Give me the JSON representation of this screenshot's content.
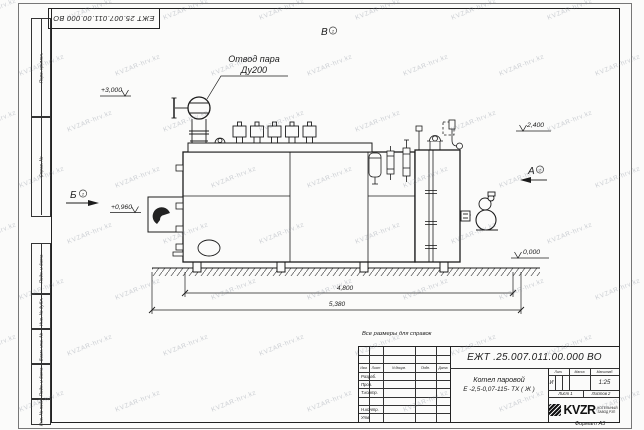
{
  "sheet": {
    "top_designation": "ЕЖТ 25.007.011.00.000  ВО",
    "format_note": "Формат А3",
    "left_cells": [
      "Перв. примен.",
      "Справ. №",
      "Подп. и дата",
      "Инв. № дубл.",
      "Взам. инв. №",
      "Подп. и дата",
      "Инв. № подл."
    ]
  },
  "watermark": {
    "text": "KVZAR-hrv.kz"
  },
  "drawing": {
    "note": "Все размеры для справок",
    "callout_line1": "Отвод пара",
    "callout_line2": "Ду200",
    "elev_3000": "+3,000",
    "elev_2400": "2,400",
    "elev_0960": "+0,960",
    "elev_0000": "0,000",
    "dim_4800": "4,800",
    "dim_5380": "5,380",
    "view_a": "А",
    "view_b": "Б",
    "view_v": "В",
    "view_sheet_ref": "2"
  },
  "title_block": {
    "designation": "ЕЖТ .25.007.011.00.000  ВО",
    "product_line1": "Котел паровой",
    "product_line2": "Е -2,5-0,07-115- ТХ ( Ж )",
    "col_izm": "Изм.",
    "col_list": "Лист",
    "col_docum": "N докум.",
    "col_podp": "Подп.",
    "col_data": "Дата",
    "row_razrab": "Разраб.",
    "row_prov": "Пров.",
    "row_tkontr": "Т.контр.",
    "row_nkontr": "Н.контр.",
    "row_utv": "Утв.",
    "lit_header": "Лит.",
    "mass_header": "Масса",
    "scale_header": "Масштаб",
    "lit_value": "И",
    "scale_value": "1:25",
    "sheet_info": "Лист 1",
    "sheets_info": "Листов 2",
    "logo_text": "KVZR",
    "logo_caption1": "КОТЕЛЬНЫЙ",
    "logo_caption2": "ЗАВОД РЗП"
  }
}
